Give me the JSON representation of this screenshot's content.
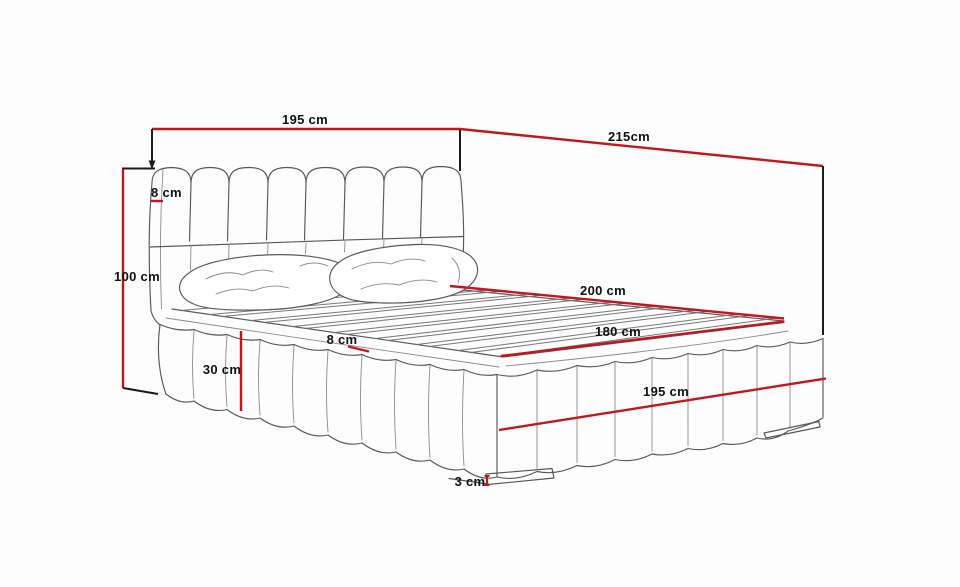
{
  "diagram": {
    "measurements": {
      "headboard_width": {
        "label": "195 cm",
        "value": 195
      },
      "frame_length": {
        "label": "215cm",
        "value": 215
      },
      "headboard_thickness": {
        "label": "8 cm",
        "value": 8
      },
      "headboard_height": {
        "label": "100 cm",
        "value": 100
      },
      "mattress_length": {
        "label": "200 cm",
        "value": 200
      },
      "mattress_width": {
        "label": "180 cm",
        "value": 180
      },
      "mattress_thickness": {
        "label": "8 cm",
        "value": 8
      },
      "base_height": {
        "label": "30 cm",
        "value": 30
      },
      "frame_width": {
        "label": "195 cm",
        "value": 195
      },
      "plinth_height": {
        "label": "3 cm",
        "value": 3
      }
    },
    "colors": {
      "dimension_line": "#c4161c",
      "tick_line": "#1b1b1b",
      "drawing_line": "#58585a",
      "label_text": "#111111",
      "background": "#fdfdfd"
    }
  }
}
